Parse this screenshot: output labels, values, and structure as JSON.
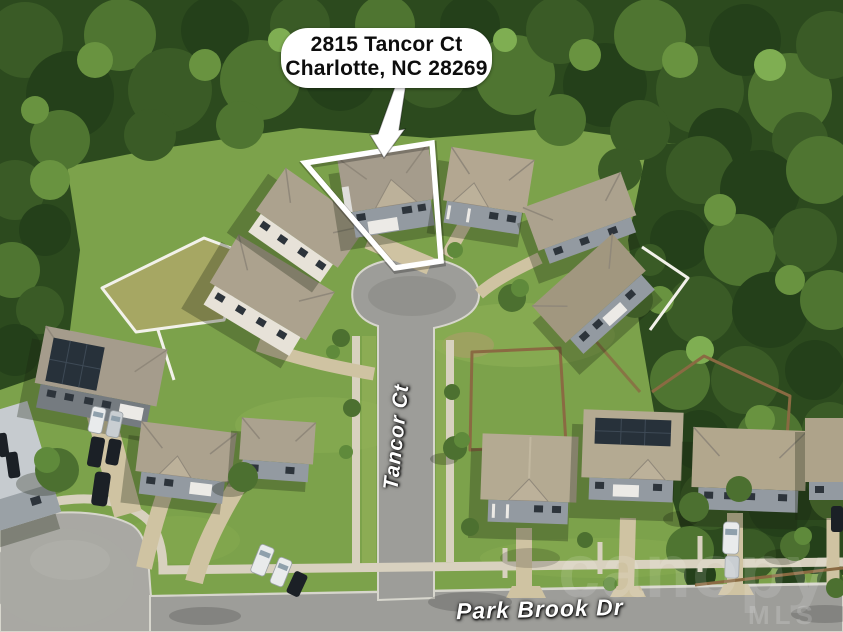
{
  "annotation": {
    "address_line1": "2815 Tancor Ct",
    "address_line2": "Charlotte, NC 28269"
  },
  "streets": {
    "cul_de_sac": "Tancor Ct",
    "main_road": "Park Brook Dr"
  },
  "watermark": {
    "brand": "canopy",
    "suffix": "MLS"
  },
  "icons": {
    "callout_arrow": "down-arrow",
    "lot_outline": "property-boundary-polygon"
  },
  "colors": {
    "callout-bg": "#ffffff",
    "callout-text": "#0d0d0d",
    "outline": "#ffffff",
    "label-text": "#ffffff",
    "road": "#9d9d99",
    "road-worn": "#a9a8a3",
    "sidewalk": "#d8d1bf",
    "driveway": "#cfc3a2",
    "lawn": "#7ca24b",
    "lawn-dry": "#a6a763",
    "forest": "#2c4a1e",
    "roof-tan": "#aca28e",
    "roof-gray": "#958c7c",
    "siding-white": "#e7e2d8",
    "siding-gray": "#939aa1",
    "fence-white": "#f2f1ea",
    "fence-wood": "#8a6a42",
    "solar": "#27313a",
    "shadow": "rgba(25,35,15,0.30)"
  }
}
